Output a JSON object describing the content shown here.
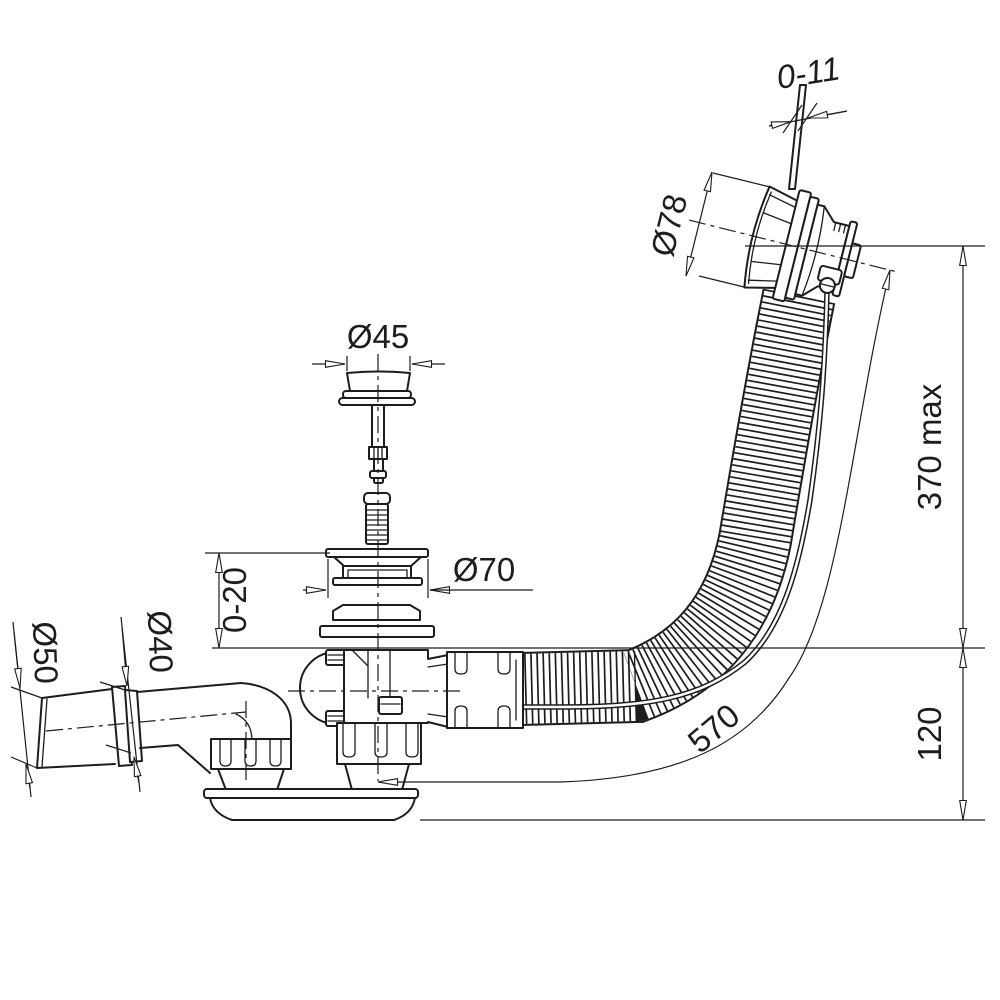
{
  "drawing": {
    "title": "Bath waste, overflow and trap - dimensioned technical drawing",
    "line_color": "#1d1d1f",
    "background_color": "#ffffff",
    "labels": {
      "knob_travel": "0-11",
      "overflow_diameter": "Ø78",
      "plug_diameter": "Ø45",
      "flange_diameter": "Ø70",
      "deck_thickness": "0-20",
      "outlet_outer_diameter": "Ø50",
      "outlet_pipe_diameter": "Ø40",
      "installation_height": "370 max",
      "trap_depth": "120",
      "hose_length": "570"
    }
  }
}
